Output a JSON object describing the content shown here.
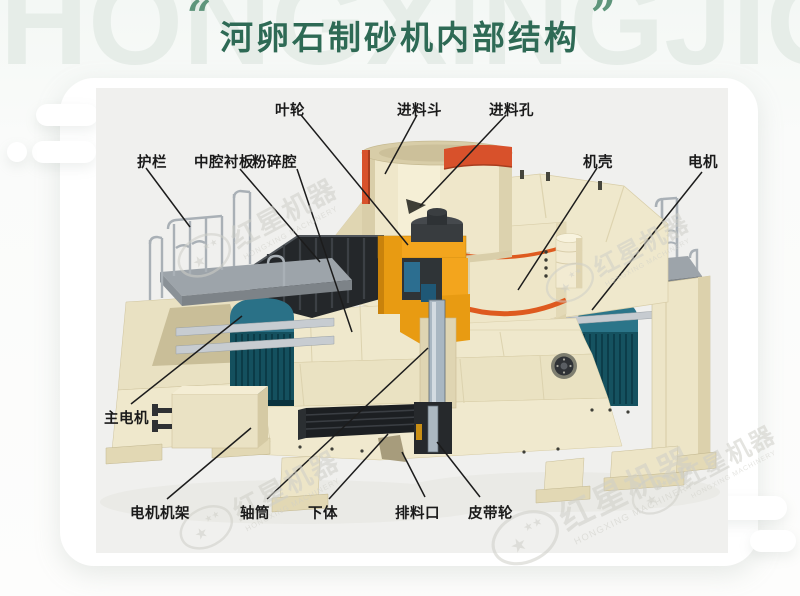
{
  "page": {
    "background_watermark": "HONGXINGJIQI"
  },
  "title": {
    "text": "河卵石制砂机内部结构",
    "open_quote": "“",
    "close_quote": "”"
  },
  "diagram": {
    "labels": [
      {
        "id": "impeller",
        "text": "叶轮",
        "x": 275,
        "y": 99,
        "line": [
          301,
          115,
          408,
          245
        ]
      },
      {
        "id": "feed-hopper",
        "text": "进料斗",
        "x": 397,
        "y": 99,
        "line": [
          417,
          115,
          385,
          174
        ]
      },
      {
        "id": "feed-hole",
        "text": "进料孔",
        "x": 489,
        "y": 99,
        "line": [
          506,
          115,
          420,
          206
        ]
      },
      {
        "id": "guardrail",
        "text": "护栏",
        "x": 137,
        "y": 151,
        "line": [
          146,
          168,
          190,
          227
        ]
      },
      {
        "id": "middle-cavity-liner",
        "text": "中腔衬板",
        "x": 194,
        "y": 151,
        "line": [
          240,
          169,
          320,
          262
        ]
      },
      {
        "id": "crushing-chamber",
        "text": "粉碎腔",
        "x": 252,
        "y": 151,
        "line": [
          297,
          169,
          352,
          332
        ]
      },
      {
        "id": "casing",
        "text": "机壳",
        "x": 583,
        "y": 151,
        "line": [
          597,
          168,
          518,
          290
        ]
      },
      {
        "id": "motor",
        "text": "电机",
        "x": 688,
        "y": 151,
        "line": [
          702,
          172,
          592,
          310
        ]
      },
      {
        "id": "main-motor",
        "text": "主电机",
        "x": 104,
        "y": 407,
        "line": [
          131,
          404,
          242,
          316
        ]
      },
      {
        "id": "motor-frame",
        "text": "电机机架",
        "x": 130,
        "y": 502,
        "line": [
          167,
          499,
          251,
          428
        ]
      },
      {
        "id": "shaft-tube",
        "text": "轴筒",
        "x": 240,
        "y": 502,
        "line": [
          267,
          499,
          428,
          348
        ]
      },
      {
        "id": "lower-body",
        "text": "下体",
        "x": 308,
        "y": 502,
        "line": [
          329,
          499,
          388,
          434
        ]
      },
      {
        "id": "discharge-port",
        "text": "排料口",
        "x": 395,
        "y": 502,
        "line": [
          425,
          497,
          402,
          452
        ]
      },
      {
        "id": "belt-pulley",
        "text": "皮带轮",
        "x": 468,
        "y": 502,
        "line": [
          480,
          497,
          437,
          442
        ]
      }
    ],
    "watermark": {
      "cn": "红星机器",
      "en": "HONGXING MACHINERY",
      "stamps": [
        {
          "x": 260,
          "y": 228,
          "r": -28,
          "s": 1
        },
        {
          "x": 620,
          "y": 258,
          "r": -28,
          "s": 0.9
        },
        {
          "x": 596,
          "y": 506,
          "r": -26,
          "s": 1.25
        },
        {
          "x": 262,
          "y": 500,
          "r": -28,
          "s": 1
        },
        {
          "x": 706,
          "y": 470,
          "r": -28,
          "s": 0.9
        }
      ]
    }
  },
  "colors": {
    "title_green": "#2E6A55",
    "quote_green": "#5E957B",
    "background_watermark": "#E6EDE8",
    "label_text": "#1A1A1A",
    "leader_line": "#1C1C1C",
    "machine_cream": "#EFE8CC",
    "hopper_red_band": "#D8512B",
    "casing_orange_stripe": "#DE5A1F",
    "motor_teal": "#155260",
    "impeller_yellow": "#F3A51D",
    "platform_gray": "#9DA4AA",
    "dark_parts": "#24272A",
    "stage_background": "#F0F0EE",
    "card_background": "#FFFFFF"
  }
}
